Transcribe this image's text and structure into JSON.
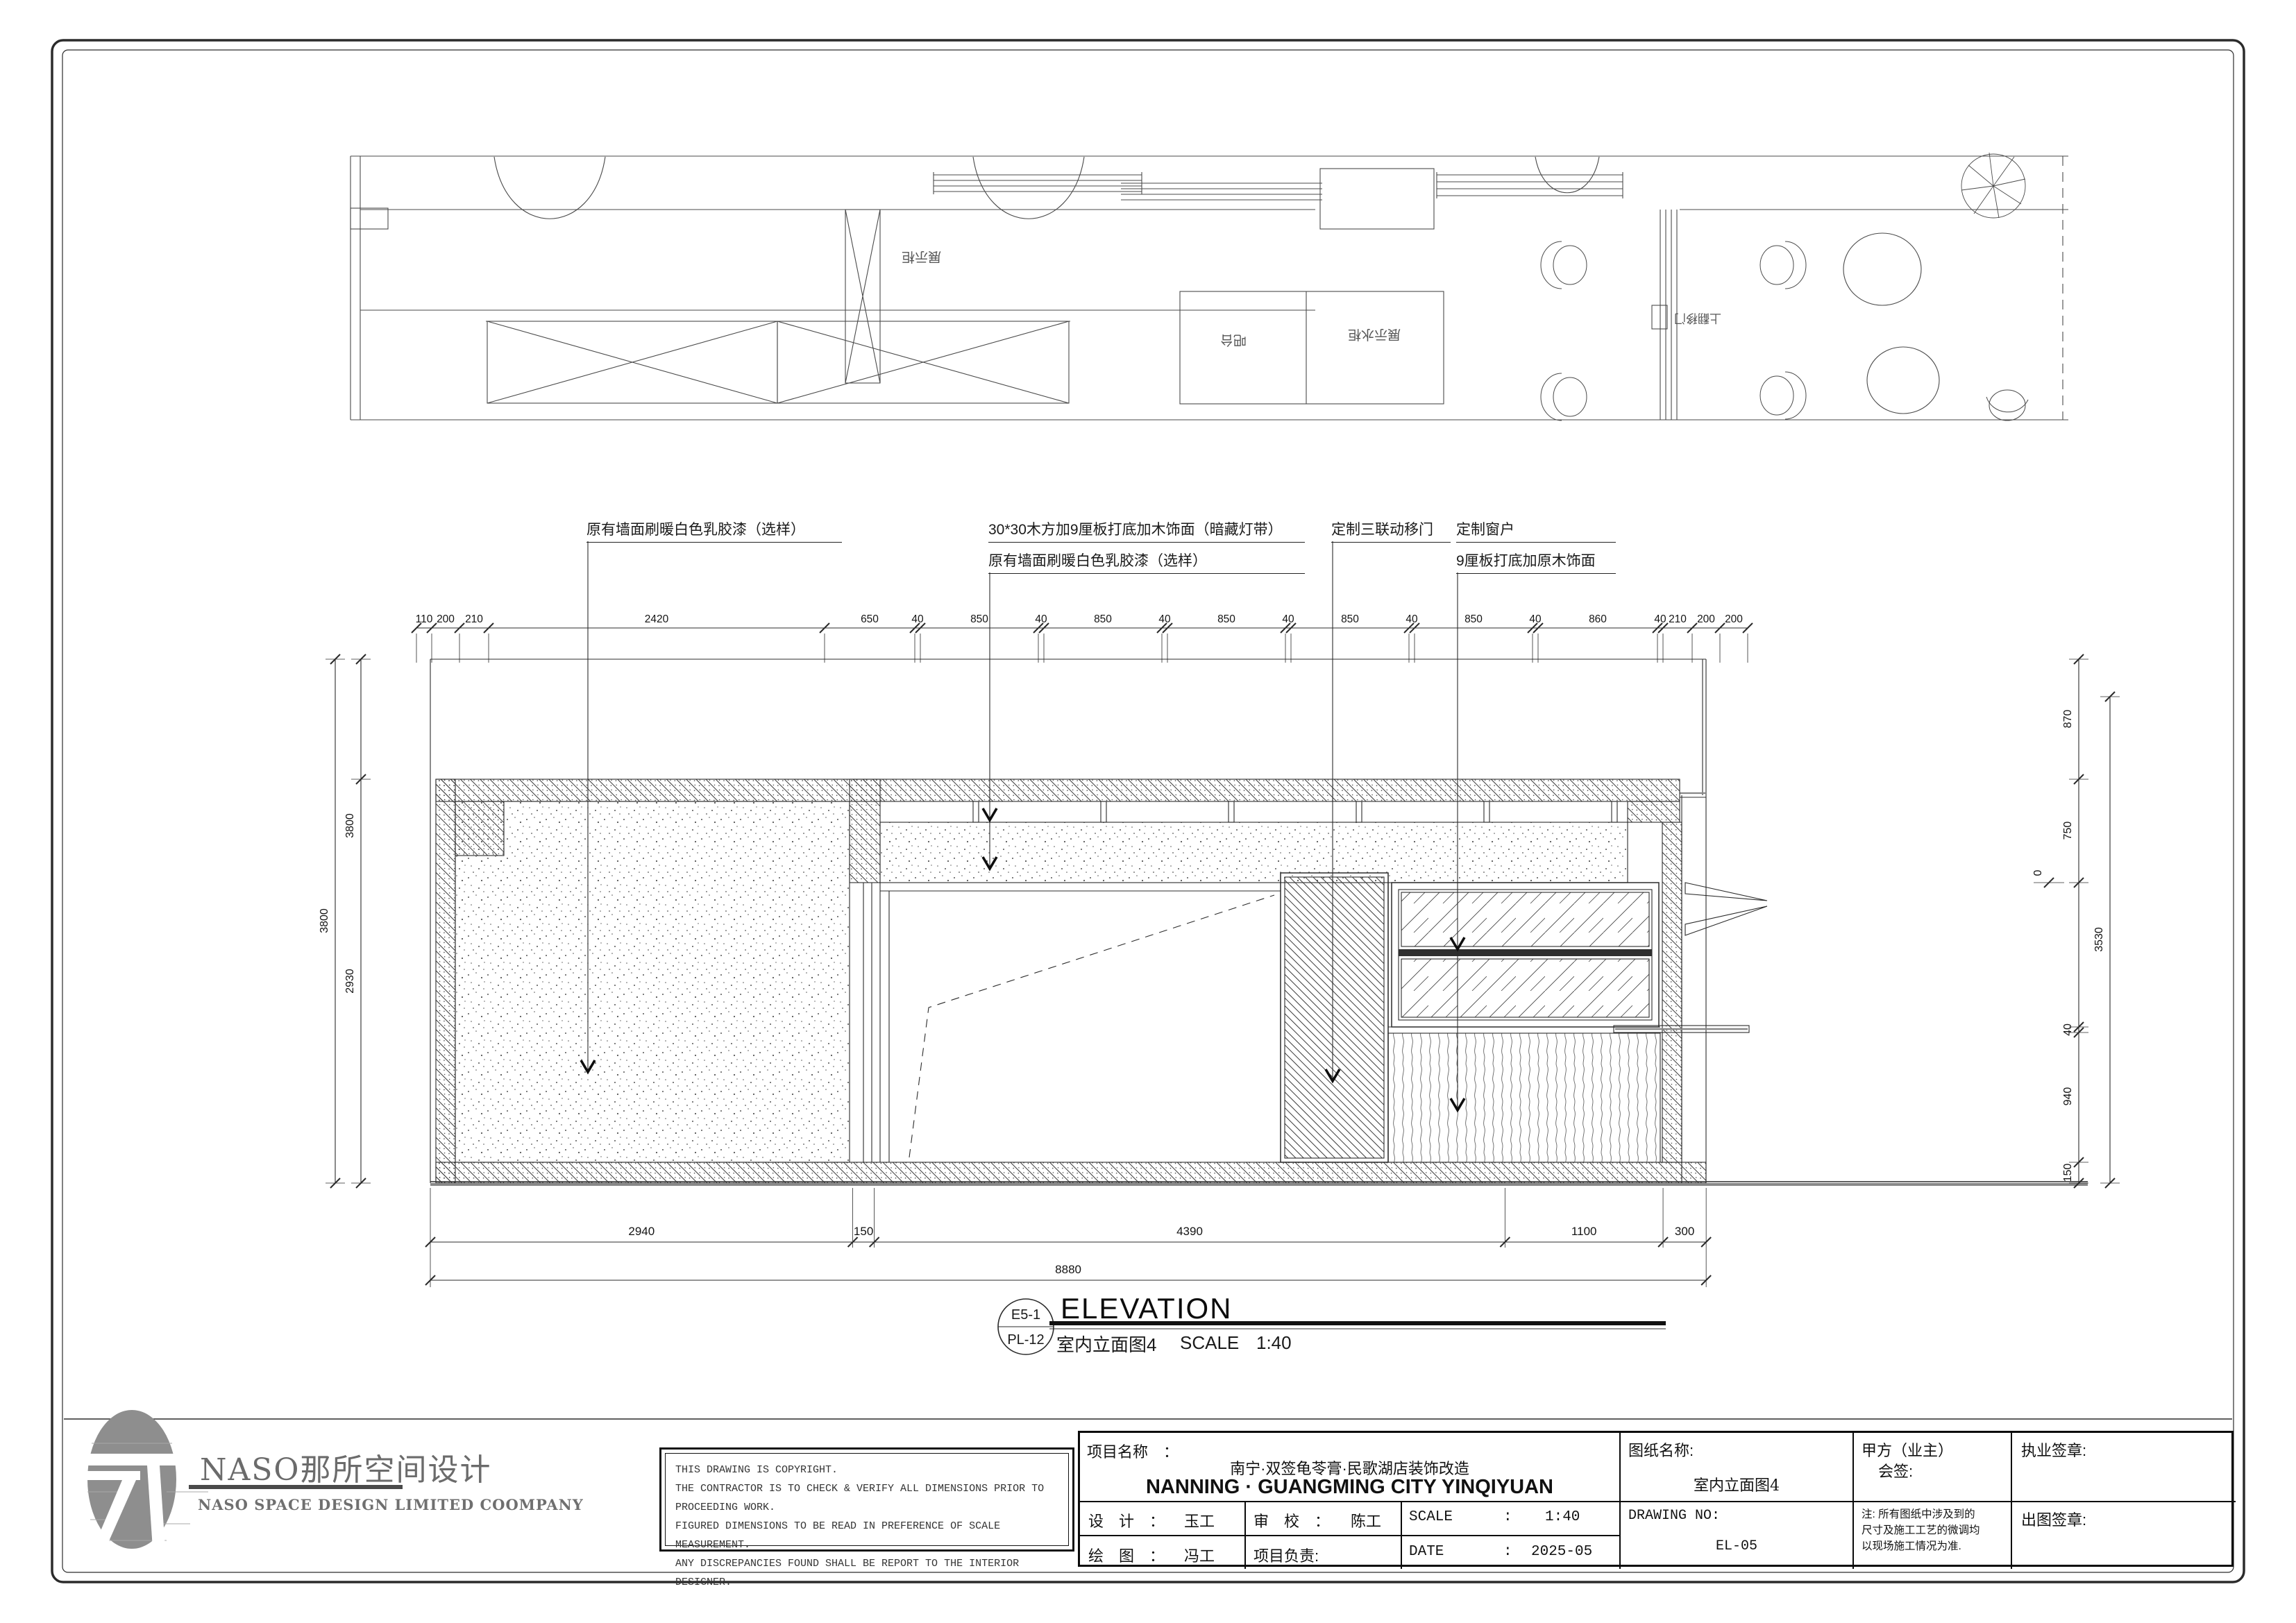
{
  "plan": {
    "display_cabinet": "展示柜",
    "bar_counter": "吧台",
    "display_water_cabinet": "展示水柜",
    "flip_sliding_door": "上翻移门"
  },
  "annotations": {
    "wall_paint_left": "原有墙面刷暖白色乳胶漆（选样）",
    "wood_batten": "30*30木方加9厘板打底加木饰面（暗藏灯带）",
    "wall_paint_mid": "原有墙面刷暖白色乳胶漆（选样）",
    "sliding_door": "定制三联动移门",
    "custom_window": "定制窗户",
    "window_finish": "9厘板打底加原木饰面"
  },
  "dims": {
    "top": [
      "110",
      "200",
      "210",
      "2420",
      "650",
      "40",
      "850",
      "40",
      "850",
      "40",
      "850",
      "40",
      "850",
      "40",
      "850",
      "40",
      "860",
      "40",
      "210",
      "200",
      "200"
    ],
    "bottom": [
      "2940",
      "150",
      "4390",
      "1100",
      "300"
    ],
    "bottom_total": "8880",
    "left_outer": "3800",
    "left_inner_upper": "3800",
    "left_inner_lower": "2930",
    "right": [
      "870",
      "750",
      "40",
      "940",
      "150"
    ],
    "right_outer": "3530",
    "level_zero": "0"
  },
  "drawing_title": {
    "ref_top": "E5-1",
    "ref_bottom": "PL-12",
    "title_en": "ELEVATION",
    "title_cn": "室内立面图4",
    "scale_label": "SCALE",
    "scale_value": "1:40"
  },
  "logo": {
    "cn": "NASO那所空间设计",
    "en": "NASO SPACE DESIGN LIMITED COOMPANY"
  },
  "copyright_lines": [
    "THIS DRAWING IS COPYRIGHT.",
    "THE CONTRACTOR IS TO CHECK & VERIFY ALL DIMENSIONS PRIOR TO PROCEEDING WORK.",
    "FIGURED DIMENSIONS TO BE READ IN PREFERENCE OF SCALE MEASUREMENT.",
    "ANY DISCREPANCIES FOUND SHALL BE REPORT TO THE INTERIOR DESIGNER."
  ],
  "titleblock": {
    "project_label": "项目名称　：",
    "project_cn": "南宁·双签龟苓膏·民歌湖店装饰改造",
    "project_en": "NANNING · GUANGMING CITY YINQIYUAN",
    "design_label": "设　计　：",
    "design_value": "玉工",
    "check_label": "审　校　：",
    "check_value": "陈工",
    "scale_label": "SCALE",
    "colon": ":",
    "scale_value": "1:40",
    "draw_label": "绘　图　：",
    "draw_value": "冯工",
    "lead_label": "项目负责:",
    "date_label": "DATE",
    "date_value": "2025-05",
    "sheet_name_label": "图纸名称:",
    "sheet_name_value": "室内立面图4",
    "drawing_no_label": "DRAWING NO:",
    "drawing_no_value": "EL-05",
    "client_label": "甲方（业主）",
    "client_sub": "会签:",
    "note_lines": [
      "注: 所有图纸中涉及到的",
      "尺寸及施工工艺的微调均",
      "以现场施工情况为准."
    ],
    "license_seal": "执业签章:",
    "issue_seal": "出图签章:"
  }
}
